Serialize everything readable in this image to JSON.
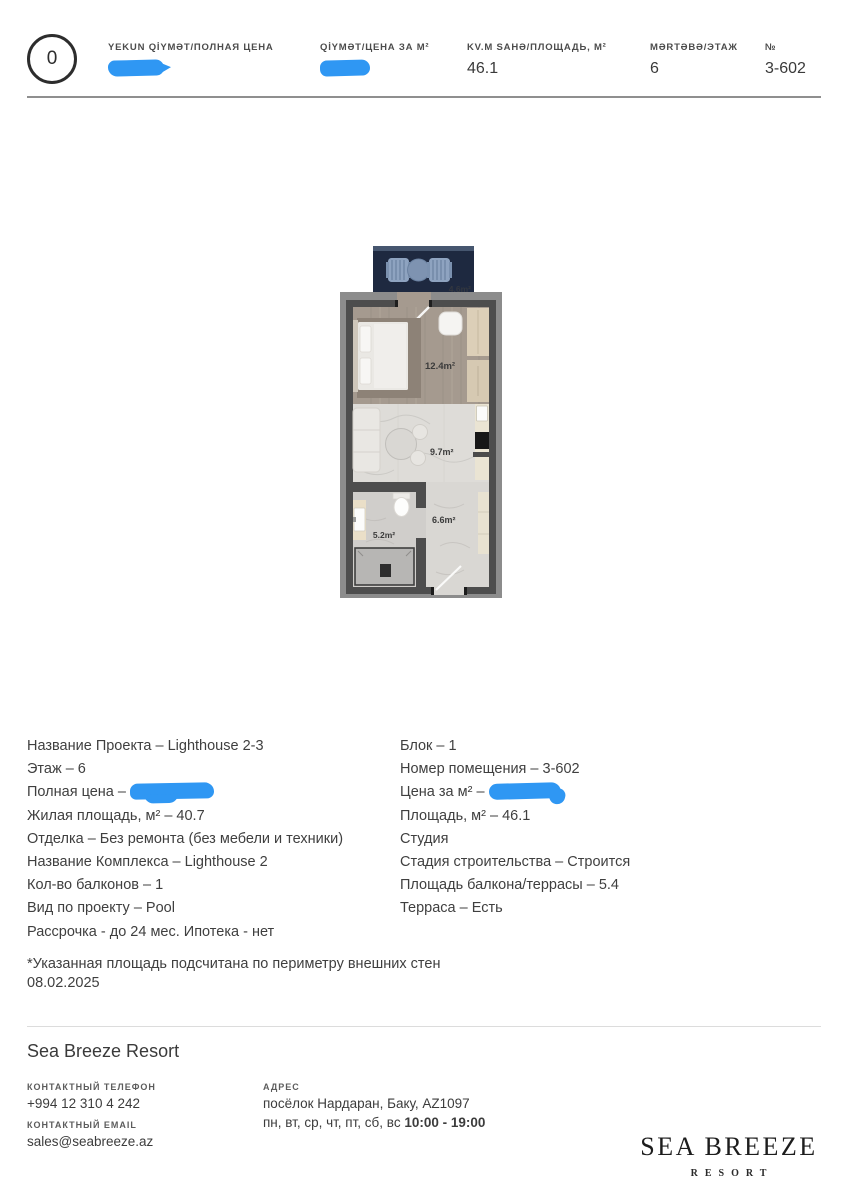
{
  "header": {
    "marker": "0",
    "fields": [
      {
        "label": "YEKUN QİYMƏT/ПОЛНАЯ ЦЕНА",
        "value": "",
        "redacted": true
      },
      {
        "label": "QİYMƏT/ЦЕНА ЗА М²",
        "value": "",
        "redacted": true
      },
      {
        "label": "KV.M SAHƏ/ПЛОЩАДЬ, М²",
        "value": "46.1",
        "redacted": false
      },
      {
        "label": "MƏRTƏBƏ/ЭТАЖ",
        "value": "6",
        "redacted": false
      },
      {
        "label": "№",
        "value": "3-602",
        "redacted": false
      }
    ]
  },
  "floor_plan": {
    "rooms": [
      {
        "name": "balcony",
        "area_label": "4.6m²"
      },
      {
        "name": "bedroom",
        "area_label": "12.4m²"
      },
      {
        "name": "living-kitchen",
        "area_label": "9.7m²"
      },
      {
        "name": "bathroom",
        "area_label": "5.2m²"
      },
      {
        "name": "hallway",
        "area_label": "6.6m²"
      }
    ]
  },
  "details": {
    "left": [
      "Название Проекта – Lighthouse 2-3",
      "Этаж – 6",
      "Полная цена –",
      "Жилая площадь, м² – 40.7",
      "Отделка – Без ремонта (без мебели и техники)",
      "Название Комплекса – Lighthouse 2",
      "Кол-во балконов – 1",
      "Вид по проекту – Pool",
      "Рассрочка - до 24 мес. Ипотека - нет"
    ],
    "right": [
      "Блок – 1",
      "Номер помещения – 3-602",
      "Цена за м² –",
      "Площадь, м² – 46.1",
      "Студия",
      "Стадия строительства – Строится",
      "Площадь балкона/террасы – 5.4",
      "Терраса – Есть"
    ],
    "footnote": "*Указанная площадь подсчитана по периметру внешних стен",
    "date": "08.02.2025"
  },
  "footer": {
    "company": "Sea Breeze Resort",
    "phone_label": "КОНТАКТНЫЙ ТЕЛЕФОН",
    "phone": "+994 12 310 4 242",
    "email_label": "КОНТАКТНЫЙ EMAIL",
    "email": "sales@seabreeze.az",
    "address_label": "АДРЕС",
    "address": "посёлок Нардаран, Баку, AZ1097",
    "hours_days": "пн, вт, ср, чт, пт, сб, вс",
    "hours_time": "10:00 - 19:00",
    "logo_title": "SEA BREEZE",
    "logo_subtitle": "RESORT"
  },
  "colors": {
    "redaction_blue": "#2f97f3",
    "text": "#3e3e3e",
    "rule_gray": "#8f8f8f",
    "wall_gray": "#4d4d4d",
    "balcony_navy": "#1e2940"
  }
}
